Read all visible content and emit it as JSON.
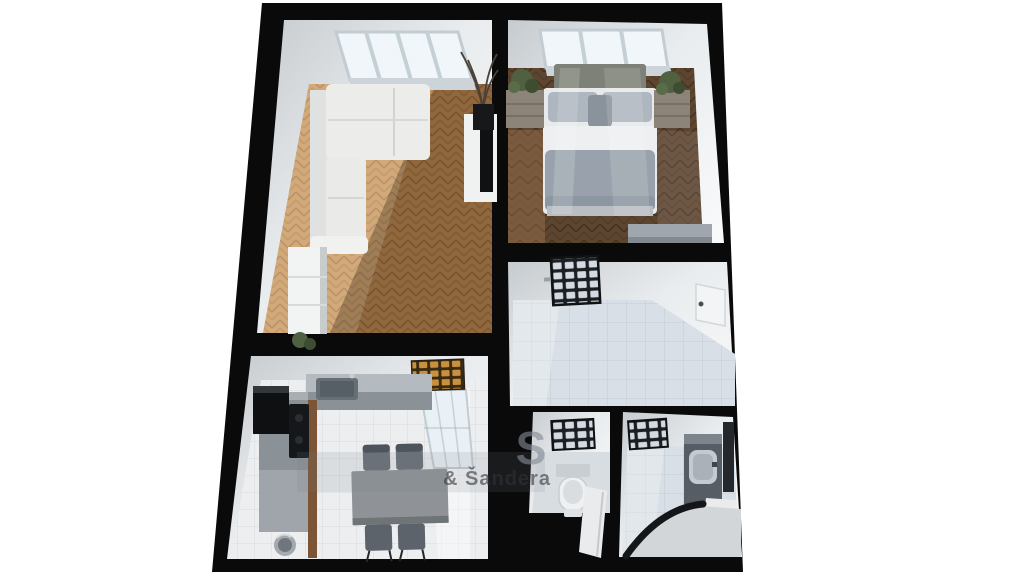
{
  "scene": {
    "type": "3d-floor-plan-top-view-render",
    "watermark": {
      "letter": "S",
      "subtext": "& Šandera"
    },
    "rooms": [
      {
        "id": "living-room",
        "floor": "light-oak-herringbone",
        "objects": [
          "skylight-windows",
          "corner-sofa",
          "tv-board",
          "tv",
          "tall-plant",
          "sideboard",
          "small-plant"
        ]
      },
      {
        "id": "bedroom",
        "floor": "dark-walnut-herringbone",
        "objects": [
          "windows",
          "double-bed",
          "nightstand-left",
          "nightstand-right",
          "potted-plant-left",
          "potted-plant-right",
          "bench"
        ]
      },
      {
        "id": "bathroom-large",
        "floor": "light-blue-gray-tile",
        "objects": [
          "glass-block-window",
          "door"
        ]
      },
      {
        "id": "kitchen",
        "floor": "white-tile",
        "objects": [
          "amber-glass-block-window",
          "tall-window",
          "counter-with-sink",
          "left-counter",
          "wall-cabinet",
          "cooktop",
          "trash-bin",
          "dining-table",
          "four-chairs"
        ]
      },
      {
        "id": "wc",
        "floor": "gray-tile",
        "objects": [
          "glass-block-window",
          "toilet",
          "open-door"
        ]
      },
      {
        "id": "bathroom-small",
        "floor": "light-blue-gray-tile",
        "objects": [
          "glass-block-window",
          "vanity",
          "washbasin",
          "mirror",
          "bathtub"
        ]
      }
    ]
  },
  "palette": {
    "background": "#ffffff",
    "wall": "#0a0a0b",
    "wall_face_shade": "#c6cbcf",
    "wall_face_light": "#f8f9fa",
    "parquet_light": "#c08c54",
    "parquet_light_line": "#9b6e3f",
    "parquet_dark": "#5d452f",
    "parquet_dark_line": "#463321",
    "tile_kitchen": "#eceeef",
    "tile_kitchen_line": "#d7dadc",
    "tile_bath": "#d9dfe6",
    "tile_bath_line": "#c4ccd4",
    "glass_frame": "#1b1e22",
    "glass_cell": "#d3dae1",
    "amber_frame": "#38290f",
    "amber_cell": "#c9913f",
    "window_pane": "#f0f6f9",
    "sofa": "#ececea",
    "bed_duvet": "#99a2ac",
    "counter": "#8a9298",
    "table": "#8f9397",
    "wood_accent": "#7b5536",
    "plant": "#4f6140"
  }
}
